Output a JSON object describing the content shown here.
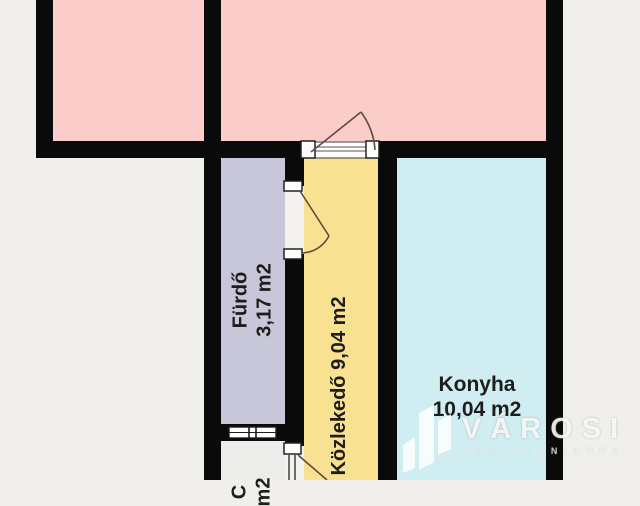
{
  "floorplan": {
    "rooms": [
      {
        "id": "furdo",
        "name": "Fürdő",
        "area": "3,17 m2"
      },
      {
        "id": "kozlekedo",
        "name": "Közlekedő",
        "area": "9,04 m2"
      },
      {
        "id": "konyha",
        "name": "Konyha",
        "area": "10,04 m2"
      },
      {
        "id": "wc-partial",
        "name_partial": "C",
        "area_partial": "m2"
      }
    ],
    "colors": {
      "room_pink": "#fbcdca",
      "room_yellow": "#f8e190",
      "room_cyan": "#d0eef2",
      "room_lavender": "#c7c7d9",
      "room_wc": "#ececea",
      "wall": "#0a0a0a",
      "background": "#f0efeb",
      "door_line": "#5f4a3e",
      "watermark": "#ffffff"
    }
  },
  "watermark": {
    "brand": "VÁROSI",
    "subtitle": "INGATLANIRODA"
  }
}
